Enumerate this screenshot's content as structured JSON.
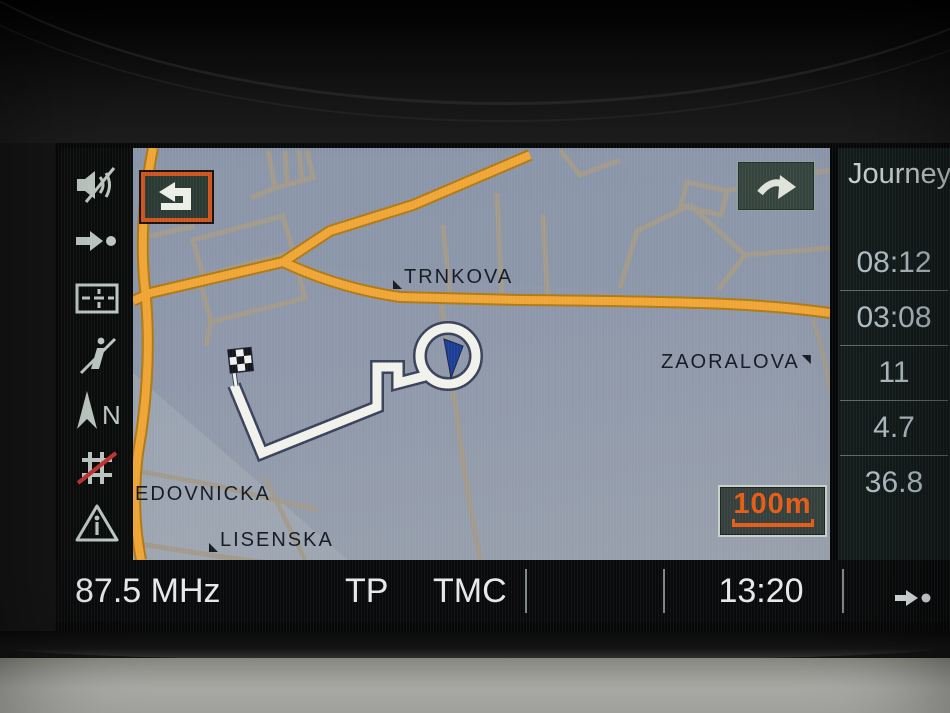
{
  "sidebar": {
    "compass_label": "N",
    "icons": [
      {
        "name": "audio-muted-icon"
      },
      {
        "name": "route-guidance-icon"
      },
      {
        "name": "split-screen-icon"
      },
      {
        "name": "info-services-off-icon"
      },
      {
        "name": "compass-north-icon",
        "label": "N"
      },
      {
        "name": "avoid-motorway-icon"
      },
      {
        "name": "traffic-info-icon"
      }
    ]
  },
  "map": {
    "back_button_icon": "return-arrow-icon",
    "panel_toggle_icon": "arrow-right-icon",
    "scale": {
      "label": "100m"
    },
    "streets": [
      {
        "name": "TRNKOVA"
      },
      {
        "name": "ZAORALOVA"
      },
      {
        "name": "EDOVNICKA"
      },
      {
        "name": "LISENSKA"
      }
    ],
    "route": {
      "destination_marker": "checkered-flag",
      "position_marker": "blue-position-arrow",
      "roundabout": true
    }
  },
  "journey_panel": {
    "title": "Journey",
    "rows": [
      "08:12",
      "03:08",
      "11",
      "4.7",
      "36.8"
    ]
  },
  "status_bar": {
    "frequency": "87.5 MHz",
    "tp_label": "TP",
    "tmc_label": "TMC",
    "time": "13:20"
  },
  "colors": {
    "accent_orange": "#e2621f",
    "road_main": "#f0a636",
    "route_white": "#f2f2ec",
    "map_background": "#8e98aa",
    "panel_text": "#b6c5cb",
    "warning_red": "#c03434"
  }
}
